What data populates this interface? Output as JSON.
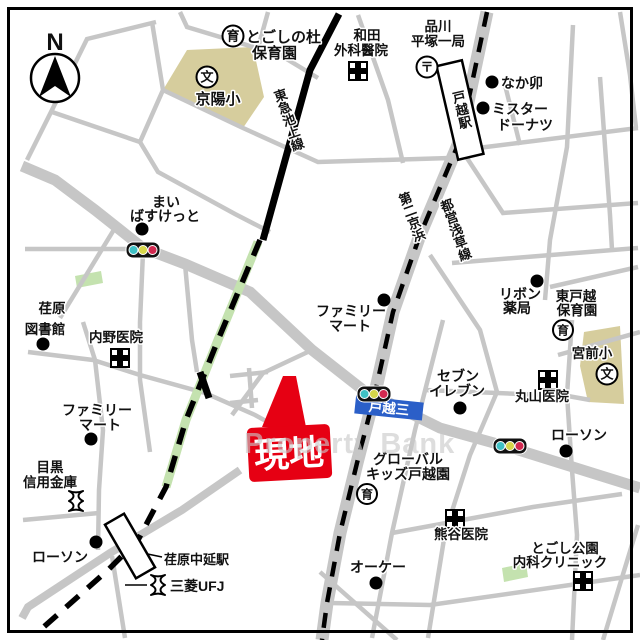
{
  "map": {
    "compass": "N",
    "watermark": "Property Bank",
    "site_marker": {
      "label": "現地"
    },
    "intersection": {
      "label": "戸越三"
    },
    "railways": {
      "tokyu_ikegami": "東急池上線",
      "toei_asakusa": "都営浅草線"
    },
    "roads": {
      "dai2_keihin": "第二京浜"
    },
    "stations": {
      "togoshi": "戸越駅",
      "ebara_nakanobu": "荏原中延駅"
    },
    "icon_glyphs": {
      "school": "文",
      "nursery": "育",
      "post": "〒"
    },
    "labels": {
      "togoshi_mori_1": "とごしの杜",
      "togoshi_mori_2": "保育園",
      "keiyo_sho": "京陽小",
      "wada_1": "和田",
      "wada_2": "外科醫院",
      "shinagawa_1": "品川",
      "shinagawa_2": "平塚一局",
      "nakau": "なか卯",
      "mister_donut_1": "ミスター",
      "mister_donut_2": "ドーナツ",
      "maibasket_1": "まい",
      "maibasket_2": "ばすけっと",
      "ribbon_1": "リボン",
      "ribbon_2": "薬局",
      "higashi_togoshi_1": "東戸越",
      "higashi_togoshi_2": "保育園",
      "miyamae_sho": "宮前小",
      "ebara_lib_1": "荏原",
      "ebara_lib_2": "図書館",
      "uchino": "内野医院",
      "famima_left_1": "ファミリー",
      "famima_left_2": "マート",
      "famima_center_1": "ファミリー",
      "famima_center_2": "マート",
      "seven_1": "セブン",
      "seven_2": "イレブン",
      "maruyama": "丸山医院",
      "lawson_right": "ローソン",
      "meguro_1": "目黒",
      "meguro_2": "信用金庫",
      "lawson_left": "ローソン",
      "mitsubishi_ufj": "三菱UFJ",
      "ok_store": "オーケー",
      "global_kids_1": "グローバル",
      "global_kids_2": "キッズ戸越園",
      "kumagai": "熊谷医院",
      "togoshi_park_1": "とごし公園",
      "togoshi_park_2": "内科クリニック"
    },
    "colors": {
      "site_red": "#e60013",
      "intersection_blue": "#2b5fc8",
      "road_gray": "#c6c6c6",
      "school_tan": "#d6cd9d",
      "park_green": "#c4e2af",
      "rail_black": "#000000",
      "signal_cyan": "#3fc0c4",
      "signal_yellow": "#d6d64a",
      "signal_red": "#d22950"
    }
  }
}
